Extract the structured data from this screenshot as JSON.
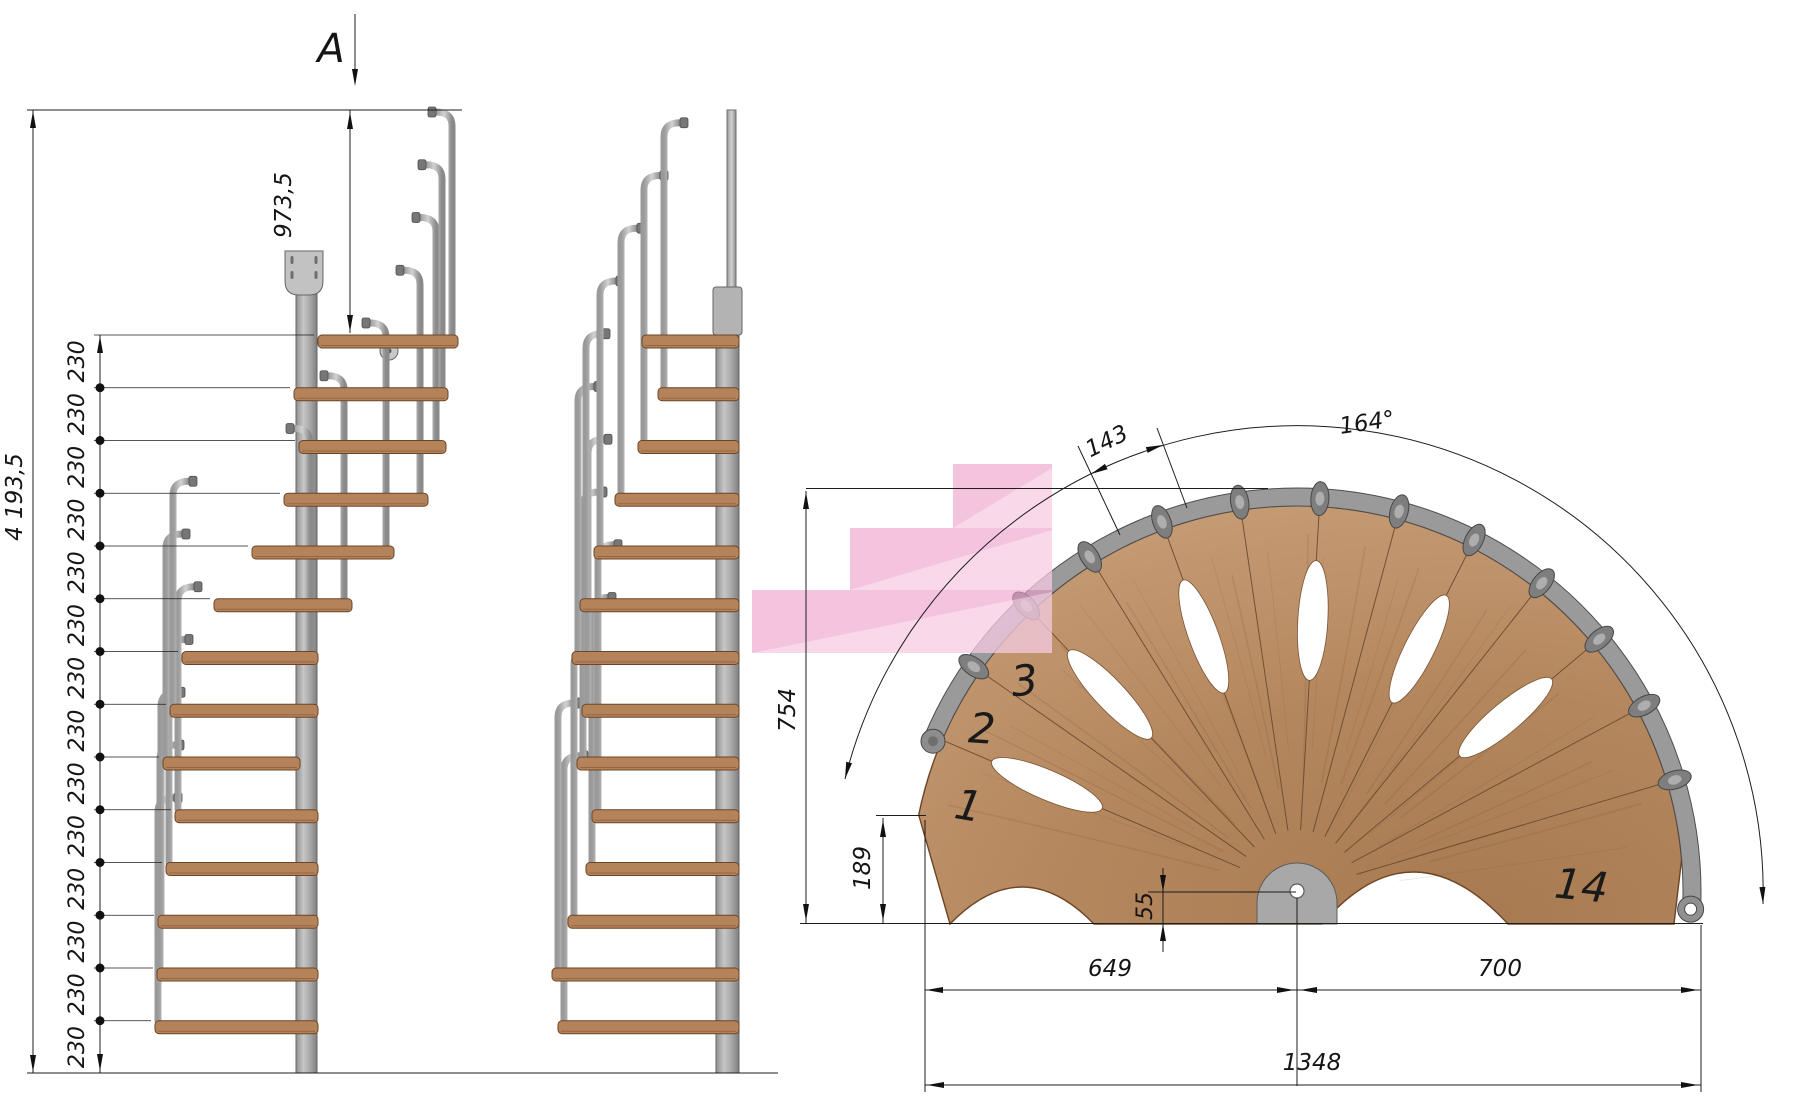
{
  "drawing": {
    "type": "spiral staircase installation drawing",
    "views": [
      "side elevation",
      "side elevation rotated",
      "plan view"
    ]
  },
  "labels": {
    "section": "A",
    "total_height": "4 193,5",
    "top_offset": "973,5",
    "riser": "230",
    "plan_radius": "754",
    "step_nose": "189",
    "pole_offset": "55",
    "left_span": "649",
    "right_span": "700",
    "total_width": "1348",
    "rotation_angle": "164°",
    "step_spacing": "143",
    "step1": "1",
    "step2": "2",
    "step3": "3",
    "step14": "14"
  },
  "colors": {
    "line": "#1d1d1d",
    "wood": "#b5835a",
    "wood_light": "#c49a73",
    "wood_dark": "#6d4426",
    "steel": "#b9b9b9",
    "steel_dark": "#6f6f6f",
    "rim": "#9a9a9a",
    "pink": "#ee9ec9"
  },
  "geom": {
    "levels": {
      "y0": 335,
      "step": 52.75,
      "n": 14,
      "floor": 1073
    },
    "chain": {
      "x": 100,
      "label_x": 84,
      "ext_targets": [
        314,
        290,
        295,
        280,
        248,
        210,
        178,
        166,
        159,
        171,
        162,
        154,
        153,
        151
      ]
    },
    "left_view": {
      "col": [
        296,
        292,
        21,
        781
      ],
      "bracket": [
        285,
        251,
        38,
        44
      ],
      "disc": [
        389,
        351
      ],
      "treads": [
        [
          155,
          318
        ],
        [
          157,
          318
        ],
        [
          158,
          318
        ],
        [
          166,
          318
        ],
        [
          175,
          318
        ],
        [
          163,
          300
        ],
        [
          170,
          318
        ],
        [
          182,
          318
        ],
        [
          214,
          352
        ],
        [
          252,
          394
        ],
        [
          284,
          428
        ],
        [
          299,
          446
        ],
        [
          294,
          448
        ],
        [
          318,
          458
        ]
      ],
      "posts": [
        [
          158,
          1
        ],
        [
          160,
          1
        ],
        [
          161,
          1
        ],
        [
          169,
          1
        ],
        [
          178,
          1
        ],
        [
          166,
          1
        ],
        [
          173,
          1
        ],
        [
          310,
          -1
        ],
        [
          344,
          -1
        ],
        [
          386,
          -1
        ],
        [
          420,
          -1
        ],
        [
          436,
          -1
        ],
        [
          442,
          -1
        ],
        [
          452,
          -1
        ]
      ],
      "post_rise": 223
    },
    "mid_view": {
      "col": [
        716,
        290,
        23,
        783
      ],
      "sleeve": [
        713,
        287,
        29,
        48
      ],
      "newel": [
        727,
        110,
        9,
        182
      ],
      "tread_x1": [
        558,
        552,
        568,
        586,
        592,
        577,
        582,
        572,
        580,
        594,
        615,
        638,
        658,
        642
      ],
      "x2": 739,
      "post_rise": 265
    },
    "plan": {
      "cx": 1297,
      "cy": 892,
      "r_wood": 386,
      "rim_r1": 386,
      "rim_r2": 404,
      "theta_start": 168.5,
      "step_angle": 11.69,
      "n_steps": 14,
      "holes_idx": [
        1,
        3,
        5,
        7,
        9,
        11
      ],
      "hole_r": 272,
      "conn_r": 394,
      "cap_theta": 157.5,
      "eye_theta": -2.5
    },
    "pink": {
      "rects": [
        [
          953,
          464,
          99,
          64
        ],
        [
          850,
          528,
          202,
          62
        ],
        [
          752,
          590,
          300,
          63
        ]
      ],
      "tris": [
        [
          953,
          528,
          1052,
          468,
          1052,
          528
        ],
        [
          850,
          590,
          1052,
          530,
          1052,
          590
        ],
        [
          752,
          653,
          1052,
          592,
          1052,
          653
        ]
      ]
    },
    "arrows": [
      [
        33,
        111,
        -90
      ],
      [
        33,
        1072,
        90
      ],
      [
        350,
        112,
        -90
      ],
      [
        350,
        332,
        90
      ],
      [
        100,
        336,
        -90
      ],
      [
        100,
        1071,
        90
      ],
      [
        355,
        86,
        90
      ],
      [
        806,
        492,
        -90
      ],
      [
        806,
        921,
        90
      ],
      [
        883,
        820,
        -90
      ],
      [
        883,
        921,
        90
      ],
      [
        1163,
        892,
        90
      ],
      [
        1163,
        924,
        -90
      ],
      [
        926,
        990,
        180
      ],
      [
        1294,
        990,
        0
      ],
      [
        1300,
        990,
        180
      ],
      [
        1698,
        990,
        0
      ],
      [
        927,
        1085,
        180
      ],
      [
        1698,
        1085,
        0
      ],
      [
        845,
        779,
        104
      ],
      [
        1763,
        904,
        88
      ],
      [
        1091,
        474,
        154
      ],
      [
        1163,
        445,
        -17
      ]
    ],
    "dots_x": 100
  }
}
